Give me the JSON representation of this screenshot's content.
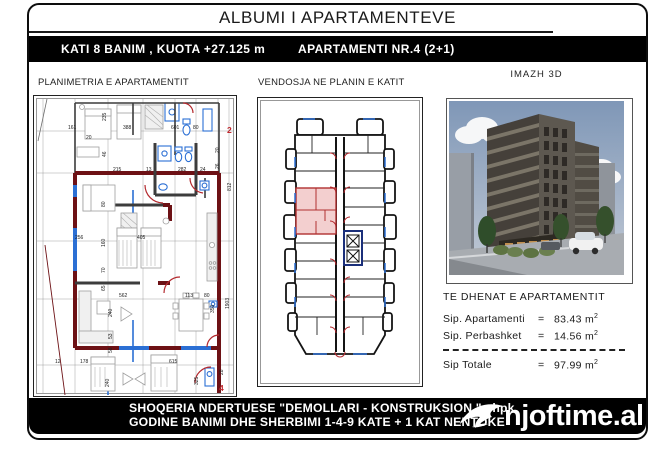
{
  "title": "ALBUMI I APARTAMENTEVE",
  "header_bar": {
    "left": "KATI 8 BANIM , KUOTA +27.125 m",
    "right": "APARTAMENTI  NR.4  (2+1)"
  },
  "panels": {
    "plan": {
      "title": "PLANIMETRIA E APARTAMENTIT",
      "scale": "SHK  1:150"
    },
    "key_plan": {
      "title": "VENDOSJA NE PLANIN E KATIT",
      "scale": "SHK  1:500"
    },
    "image3d": {
      "title": "IMAZH  3D"
    }
  },
  "apartment_data": {
    "title": "TE DHENAT E APARTAMENTIT",
    "rows": [
      {
        "label": "Sip. Apartamenti",
        "eq": "=",
        "value": "83.43",
        "unit": "m",
        "sup": "2"
      },
      {
        "label": "Sip. Perbashket",
        "eq": "=",
        "value": "14.56",
        "unit": "m",
        "sup": "2"
      }
    ],
    "total": {
      "label": "Sip Totale",
      "eq": "=",
      "value": "97.99",
      "unit": "m",
      "sup": "2"
    }
  },
  "footer": {
    "line1": "SHOQERIA NDERTUESE \"DEMOLLARI - KONSTRUKSION \" shpk",
    "line2": "GODINE BANIMI DHE SHERBIMI 1-4-9 KATE + 1 KAT NENTOKE",
    "logo_text": "njoftime.al"
  },
  "colors": {
    "wall": "#6d1115",
    "win": "#2b6fd4",
    "door": "#b3282d",
    "hl": "#f3cfcf"
  },
  "plan": {
    "dims": [
      {
        "t": "161",
        "x": 35,
        "y": 34
      },
      {
        "t": "388",
        "x": 90,
        "y": 34
      },
      {
        "t": "601",
        "x": 138,
        "y": 34
      },
      {
        "t": "80",
        "x": 160,
        "y": 34
      },
      {
        "t": "20",
        "x": 53,
        "y": 44
      },
      {
        "t": "235",
        "x": 73,
        "y": 26,
        "r": -90
      },
      {
        "t": "46",
        "x": 73,
        "y": 62,
        "r": -90
      },
      {
        "t": "215",
        "x": 80,
        "y": 76
      },
      {
        "t": "13",
        "x": 113,
        "y": 76
      },
      {
        "t": "282",
        "x": 145,
        "y": 76
      },
      {
        "t": "24",
        "x": 167,
        "y": 76
      },
      {
        "t": "812",
        "x": 198,
        "y": 96,
        "r": -90
      },
      {
        "t": "80",
        "x": 72,
        "y": 112,
        "r": -90
      },
      {
        "t": "160",
        "x": 72,
        "y": 152,
        "r": -90
      },
      {
        "t": "70",
        "x": 72,
        "y": 178,
        "r": -90
      },
      {
        "t": "65",
        "x": 72,
        "y": 196,
        "r": -90
      },
      {
        "t": "256",
        "x": 42,
        "y": 144
      },
      {
        "t": "405",
        "x": 104,
        "y": 144
      },
      {
        "t": "240",
        "x": 79,
        "y": 222,
        "r": -90
      },
      {
        "t": "53",
        "x": 79,
        "y": 244,
        "r": -90
      },
      {
        "t": "58",
        "x": 79,
        "y": 258,
        "r": -90
      },
      {
        "t": "562",
        "x": 86,
        "y": 202
      },
      {
        "t": "113",
        "x": 152,
        "y": 202
      },
      {
        "t": "80",
        "x": 171,
        "y": 202
      },
      {
        "t": "350",
        "x": 181,
        "y": 218,
        "r": -90
      },
      {
        "t": "1903",
        "x": 196,
        "y": 214,
        "r": -90
      },
      {
        "t": "12",
        "x": 22,
        "y": 268
      },
      {
        "t": "178",
        "x": 47,
        "y": 268
      },
      {
        "t": "615",
        "x": 136,
        "y": 268
      },
      {
        "t": "240",
        "x": 76,
        "y": 292,
        "r": -90
      },
      {
        "t": "325",
        "x": 165,
        "y": 290,
        "r": -90
      },
      {
        "t": "28",
        "x": 190,
        "y": 280,
        "r": -90
      },
      {
        "t": "20",
        "x": 186,
        "y": 58,
        "r": -90
      },
      {
        "t": "26",
        "x": 186,
        "y": 74,
        "r": -90
      }
    ],
    "marks": [
      {
        "t": "2",
        "x": 194,
        "y": 38,
        "c": "red"
      },
      {
        "t": "4",
        "x": 186,
        "y": 296,
        "c": "red"
      }
    ]
  }
}
